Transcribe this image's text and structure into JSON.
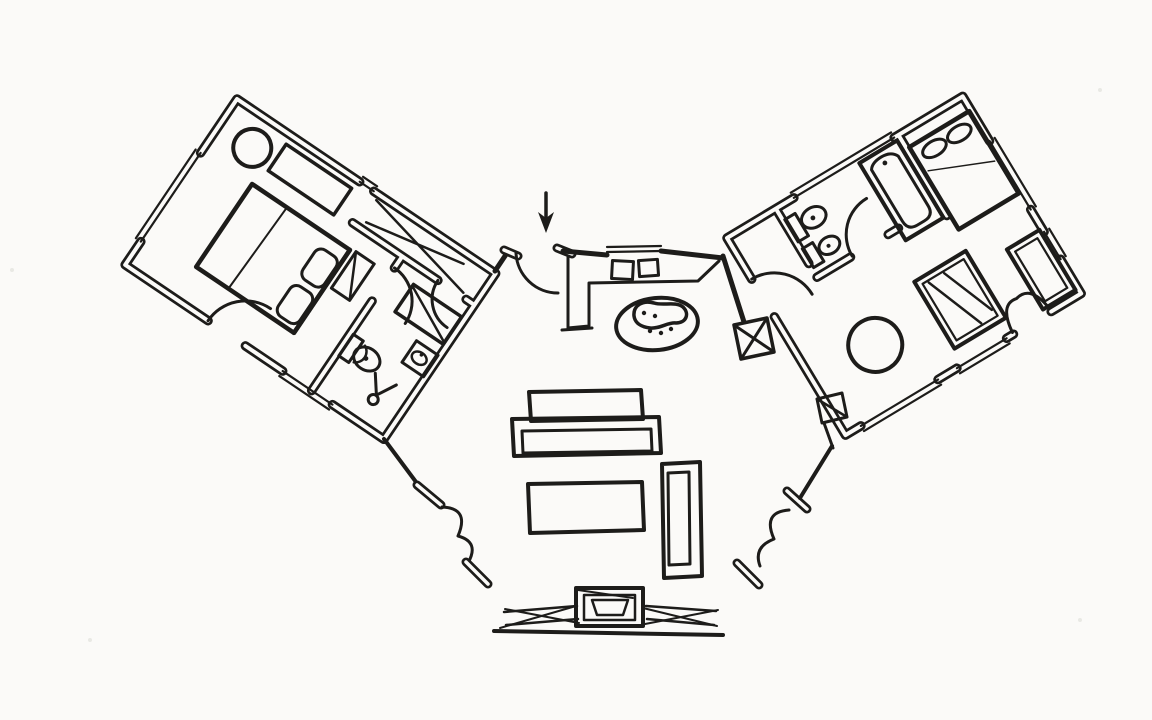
{
  "drawing": {
    "title": "Hand-drawn floor plan sketch",
    "type": "architectural-floor-plan",
    "medium": "black ink on white paper",
    "ink_color": "#1d1c1a",
    "paper_color": "#fbfaf8",
    "orientation": "two angled bedroom wings joined by a central entry, kitchen and living room",
    "annotations": [
      {
        "id": "entry-arrow",
        "meaning": "arrow pointing at the main entry door"
      }
    ]
  },
  "rooms": [
    {
      "id": "left-bedroom-suite",
      "name": "left bedroom suite",
      "furniture": [
        "round stool",
        "console desk",
        "double bed with two pillows",
        "bedside bench",
        "closet corridor with shelf diagonals",
        "vanity counter",
        "wash basin",
        "toilet",
        "shower",
        "terrace door"
      ]
    },
    {
      "id": "entry",
      "name": "entry",
      "features": [
        "front door with swing arc",
        "direction arrow"
      ]
    },
    {
      "id": "kitchen",
      "name": "kitchen",
      "furniture": [
        "L-shaped counter",
        "sink",
        "cooktop",
        "kidney-shaped island"
      ]
    },
    {
      "id": "living-room",
      "name": "living room",
      "furniture": [
        "sofa with back cushion",
        "coffee table",
        "second sofa",
        "fireplace",
        "glazed window wall left",
        "glazed window wall right",
        "french doors left",
        "french doors right",
        "braced column",
        "corner shelf"
      ]
    },
    {
      "id": "right-bathroom",
      "name": "right bathroom",
      "furniture": [
        "toilet",
        "bidet",
        "bathtub",
        "door with swing arc"
      ]
    },
    {
      "id": "right-bedroom",
      "name": "right bedroom",
      "furniture": [
        "double bed with two pillows",
        "round table",
        "wardrobe with diagonals",
        "desk",
        "french doors to terrace"
      ]
    }
  ]
}
